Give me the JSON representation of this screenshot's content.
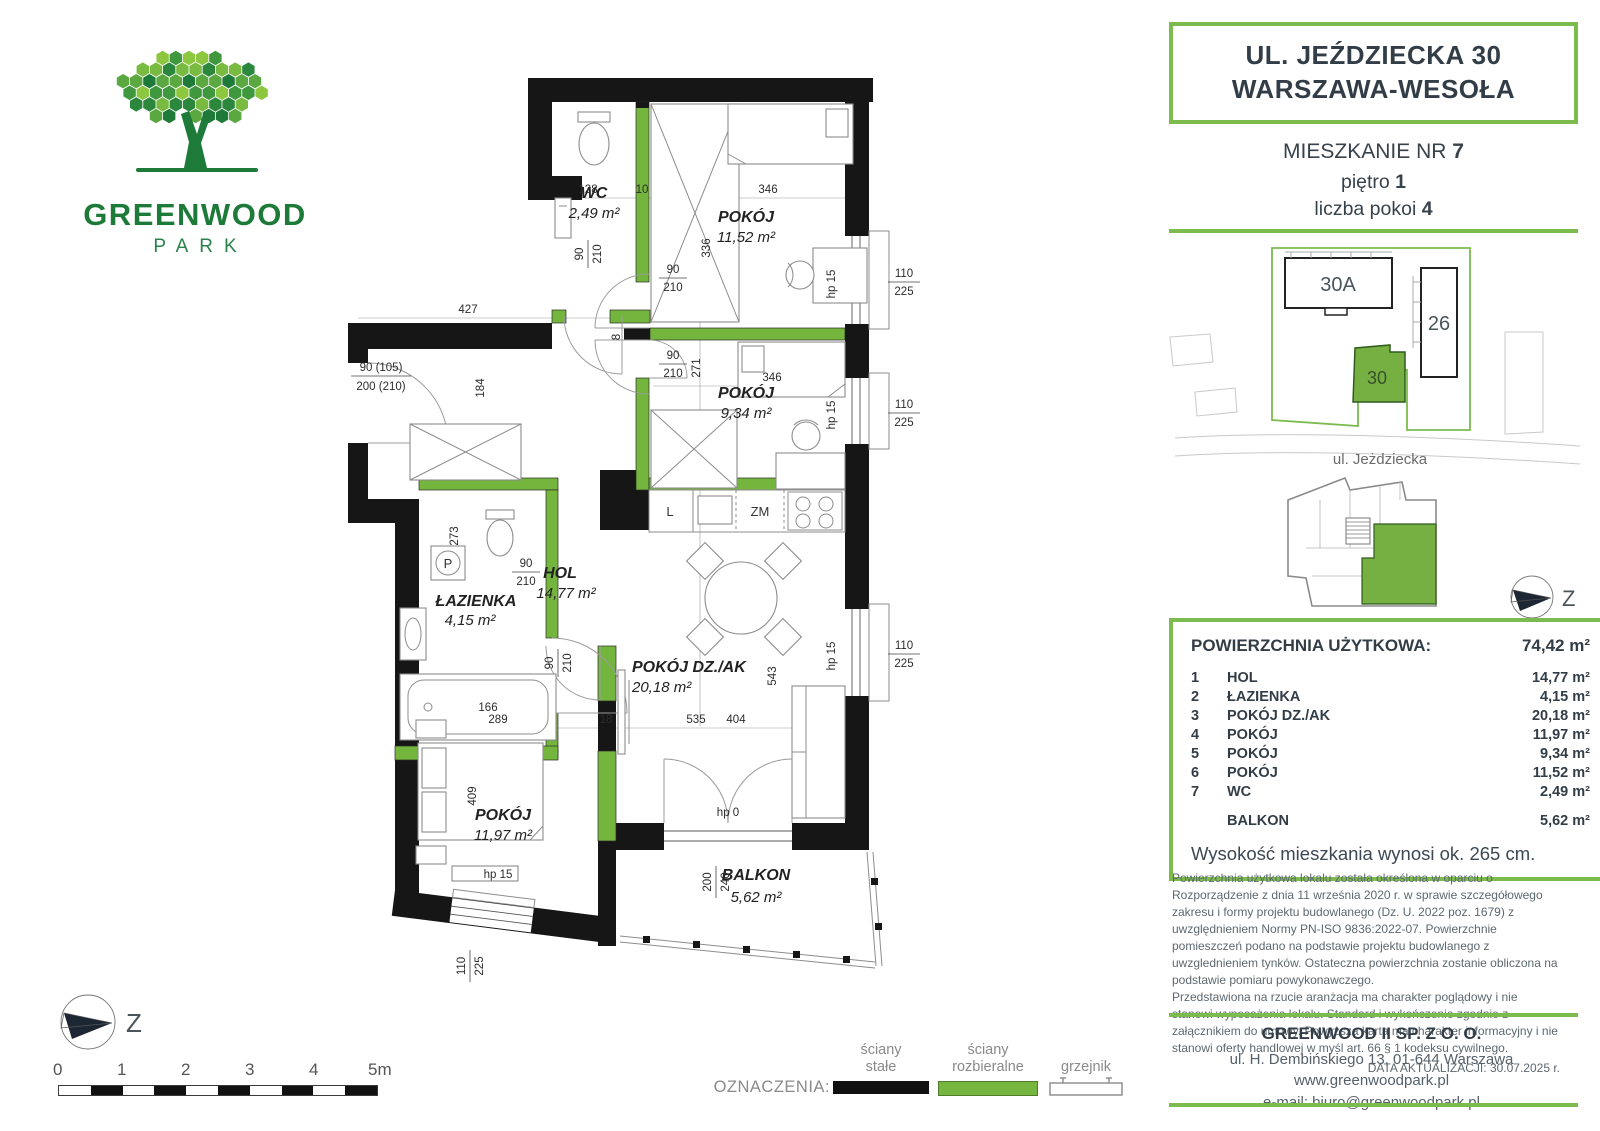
{
  "logo": {
    "title": "GREENWOOD",
    "subtitle": "PARK"
  },
  "header": {
    "address_line1": "UL. JEŹDZIECKA 30",
    "address_line2": "WARSZAWA-WESOŁA",
    "unit_label": "MIESZKANIE NR ",
    "unit_value": "7",
    "floor_label": "piętro ",
    "floor_value": "1",
    "rooms_label": "liczba pokoi ",
    "rooms_value": "4"
  },
  "site_map": {
    "building_30a": "30A",
    "building_26": "26",
    "building_30": "30",
    "street": "ul. Jeżdziecka"
  },
  "compass": {
    "label": "Z"
  },
  "area_table": {
    "title": "POWIERZCHNIA UŻYTKOWA:",
    "total": "74,42 m²",
    "rows": [
      {
        "no": "1",
        "name": "HOL",
        "area": "14,77 m²"
      },
      {
        "no": "2",
        "name": "ŁAZIENKA",
        "area": "4,15 m²"
      },
      {
        "no": "3",
        "name": "POKÓJ DZ./AK",
        "area": "20,18 m²"
      },
      {
        "no": "4",
        "name": "POKÓJ",
        "area": "11,97 m²"
      },
      {
        "no": "5",
        "name": "POKÓJ",
        "area": "9,34 m²"
      },
      {
        "no": "6",
        "name": "POKÓJ",
        "area": "11,52 m²"
      },
      {
        "no": "7",
        "name": "WC",
        "area": "2,49 m²"
      }
    ],
    "balcony_label": "BALKON",
    "balcony_value": "5,62 m²",
    "height_note": "Wysokość mieszkania wynosi ok. 265 cm."
  },
  "disclaimer": {
    "p1": "Powierzchnia użytkowa lokalu została określona w oparciu o Rozporządzenie z dnia 11 września 2020 r. w sprawie szczegółowego zakresu i formy projektu budowlanego (Dz. U. 2022 poz. 1679) z uwzględnieniem Normy PN-ISO 9836:2022-07. Powierzchnie pomieszczeń podano na podstawie projektu budowlanego z uwzglednieniem tynków. Ostateczna powierzchnia zostanie obliczona na podstawie pomiaru powykonawczego.",
    "p2": "Przedstawiona na rzucie aranżacja ma charakter poglądowy i nie stanowi wyposażenia lokalu. Standard i wykończenie zgodnie z załącznikiem do umowy. Powyższa karta ma charakter informacyjny i nie stanowi oferty handlowej w myśl art. 66 § 1 kodeksu cywilnego.",
    "date": "DATA AKTUALIZACJI: 30.07.2025 r."
  },
  "footer": {
    "company": "GREENWOOD II SP. Z O. O.",
    "address": "ul. H. Dembińskiego 13, 01-644 Warszawa",
    "website": "www.greenwoodpark.pl",
    "email": "e-mail: biuro@greenwoodpark.pl"
  },
  "legend": {
    "label": "OZNACZENIA:",
    "solid_l1": "ściany",
    "solid_l2": "stałe",
    "demount_l1": "ściany",
    "demount_l2": "rozbieralne",
    "radiator": "grzejnik"
  },
  "scale": {
    "t0": "0",
    "t1": "1",
    "t2": "2",
    "t3": "3",
    "t4": "4",
    "t5": "5m"
  },
  "plan": {
    "rooms": {
      "wc": {
        "name": "WC",
        "area": "2,49 m²"
      },
      "pokoj6": {
        "name": "POKÓJ",
        "area": "11,52 m²"
      },
      "pokoj5": {
        "name": "POKÓJ",
        "area": "9,34 m²"
      },
      "lazienka": {
        "name": "ŁAZIENKA",
        "area": "4,15 m²"
      },
      "hol": {
        "name": "HOL",
        "area": "14,77 m²"
      },
      "dz": {
        "name": "POKÓJ DZ./AK",
        "area": "20,18 m²"
      },
      "pokoj4": {
        "name": "POKÓJ",
        "area": "11,97 m²"
      },
      "balkon": {
        "name": "BALKON",
        "area": "5,62 m²"
      }
    },
    "kitchen": {
      "fridge": "L",
      "dishwasher": "ZM"
    },
    "bath": {
      "washer": "P"
    },
    "dims": {
      "d128": "128",
      "d10": "10",
      "d336": "336",
      "d346": "346",
      "d427": "427",
      "d184": "184",
      "d271": "271",
      "d273": "273",
      "d535": "535",
      "d543": "543",
      "d289": "289",
      "d18": "18",
      "d404": "404",
      "d409": "409",
      "d8": "8",
      "door_w": "90",
      "door_h": "210",
      "win_w": "110",
      "win_h": "225",
      "hp15": "hp 15",
      "hp0": "hp 0",
      "bal_w": "200",
      "bal_h": "240",
      "entry_w": "90 (105)",
      "entry_h": "200 (210)",
      "tub": "166"
    }
  }
}
